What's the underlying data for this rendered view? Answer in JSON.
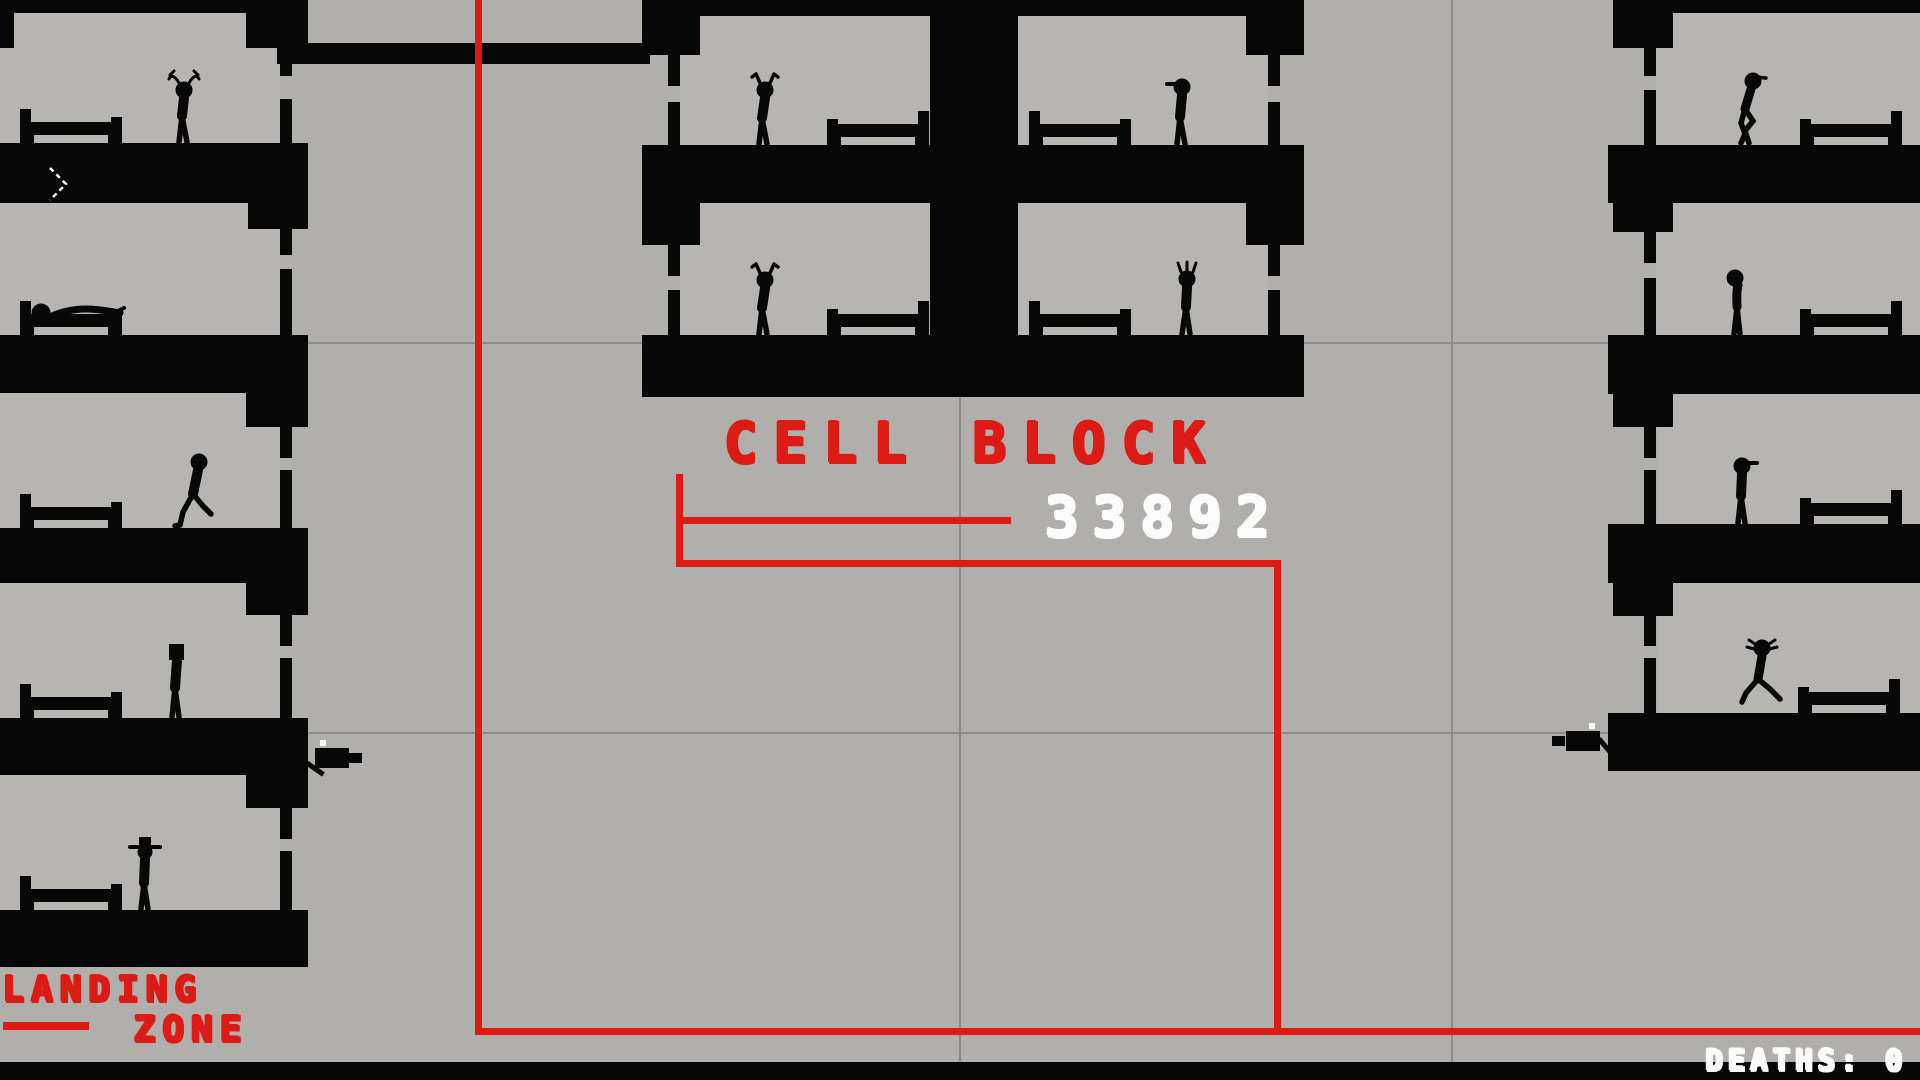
{
  "palette": {
    "background_gray": "#b1afac",
    "cell_interior_gray": "#b7b5b2",
    "structure_black": "#070707",
    "accent_red": "#dd1b15",
    "text_white": "#fbfbfb",
    "gridline_gray": "#8f8d8b"
  },
  "labels": {
    "cell_block_title": "CELL BLOCK",
    "cell_number": "33892",
    "landing_line1": "LANDING",
    "landing_line2": "ZONE"
  },
  "hud": {
    "deaths_counter": "DEATHS: 0"
  },
  "gridlines": {
    "vertical_x": [
      959,
      1451
    ],
    "horizontal_y": [
      342,
      732
    ]
  },
  "red_path": [
    [
      "route-vertical-main",
      475,
      0,
      7,
      1035
    ],
    [
      "route-horizontal-bottom",
      475,
      1028,
      1445,
      7
    ],
    [
      "callout-vertical-label",
      676,
      474,
      7,
      92
    ],
    [
      "callout-horizontal-number",
      676,
      517,
      335,
      7
    ],
    [
      "callout-horizontal-long",
      676,
      560,
      605,
      7
    ],
    [
      "callout-vertical-right",
      1274,
      560,
      7,
      475
    ],
    [
      "landing-dash",
      3,
      1022,
      86,
      8
    ]
  ],
  "interiors": [
    [
      "cell-left-1",
      0,
      13,
      280,
      130
    ],
    [
      "cell-left-2",
      0,
      203,
      280,
      132
    ],
    [
      "cell-left-3",
      0,
      393,
      280,
      135
    ],
    [
      "cell-left-4",
      0,
      583,
      280,
      135
    ],
    [
      "cell-left-5",
      0,
      775,
      280,
      135
    ],
    [
      "cell-center-top-left",
      680,
      16,
      250,
      129
    ],
    [
      "cell-center-top-right",
      1018,
      16,
      250,
      129
    ],
    [
      "cell-center-bottom-left",
      680,
      203,
      250,
      132
    ],
    [
      "cell-center-bottom-right",
      1018,
      203,
      250,
      132
    ],
    [
      "cell-right-1",
      1656,
      13,
      264,
      132
    ],
    [
      "cell-right-2",
      1656,
      203,
      264,
      132
    ],
    [
      "cell-right-3",
      1657,
      394,
      263,
      130
    ],
    [
      "cell-right-4",
      1657,
      583,
      263,
      130
    ]
  ],
  "structures": [
    [
      "left-ceiling",
      0,
      0,
      250,
      13
    ],
    [
      "left-top-stub",
      0,
      13,
      14,
      35
    ],
    [
      "left-corner-1",
      246,
      0,
      62,
      48
    ],
    [
      "left-doorwall-1a",
      280,
      48,
      12,
      28
    ],
    [
      "left-doorwall-1b",
      280,
      99,
      12,
      44
    ],
    [
      "left-floor-1",
      0,
      143,
      308,
      60
    ],
    [
      "left-corner-2",
      248,
      203,
      60,
      26
    ],
    [
      "left-doorwall-2a",
      280,
      229,
      12,
      26
    ],
    [
      "left-doorwall-2b",
      280,
      269,
      12,
      66
    ],
    [
      "left-floor-2",
      0,
      335,
      308,
      58
    ],
    [
      "left-corner-3",
      246,
      393,
      62,
      34
    ],
    [
      "left-doorwall-3a",
      280,
      427,
      12,
      31
    ],
    [
      "left-doorwall-3b",
      280,
      470,
      12,
      58
    ],
    [
      "left-floor-3",
      0,
      528,
      308,
      55
    ],
    [
      "left-corner-4",
      246,
      583,
      62,
      32
    ],
    [
      "left-doorwall-4a",
      280,
      615,
      12,
      31
    ],
    [
      "left-doorwall-4b",
      280,
      658,
      12,
      60
    ],
    [
      "left-floor-4",
      0,
      718,
      308,
      57
    ],
    [
      "left-corner-5",
      246,
      775,
      62,
      33
    ],
    [
      "left-doorwall-5a",
      280,
      808,
      12,
      31
    ],
    [
      "left-doorwall-5b",
      280,
      851,
      12,
      59
    ],
    [
      "left-floor-5",
      0,
      910,
      308,
      57
    ],
    [
      "corridor-bridge-bar",
      277,
      43,
      373,
      21
    ],
    [
      "center-ceiling",
      642,
      0,
      662,
      16
    ],
    [
      "center-corner-tl",
      642,
      0,
      58,
      55
    ],
    [
      "center-corner-tr",
      1246,
      0,
      58,
      55
    ],
    [
      "center-doorwall-l1a",
      668,
      55,
      12,
      31
    ],
    [
      "center-doorwall-l1b",
      668,
      102,
      12,
      43
    ],
    [
      "center-doorwall-r1a",
      1268,
      55,
      12,
      31
    ],
    [
      "center-doorwall-r1b",
      1268,
      102,
      12,
      43
    ],
    [
      "center-pillar",
      930,
      16,
      88,
      319
    ],
    [
      "center-floor-1",
      642,
      145,
      662,
      58
    ],
    [
      "center-corner-ml",
      642,
      203,
      58,
      42
    ],
    [
      "center-corner-mr",
      1246,
      203,
      58,
      42
    ],
    [
      "center-doorwall-l2a",
      668,
      245,
      12,
      31
    ],
    [
      "center-doorwall-l2b",
      668,
      290,
      12,
      45
    ],
    [
      "center-doorwall-r2a",
      1268,
      245,
      12,
      31
    ],
    [
      "center-doorwall-r2b",
      1268,
      290,
      12,
      45
    ],
    [
      "center-floor-2",
      642,
      335,
      662,
      62
    ],
    [
      "right-ceiling",
      1613,
      0,
      307,
      13
    ],
    [
      "right-corner-1",
      1613,
      13,
      60,
      35
    ],
    [
      "right-doorwall-1a",
      1644,
      48,
      12,
      28
    ],
    [
      "right-doorwall-1b",
      1644,
      90,
      12,
      55
    ],
    [
      "right-floor-1",
      1608,
      145,
      312,
      58
    ],
    [
      "right-corner-2",
      1613,
      203,
      60,
      29
    ],
    [
      "right-doorwall-2a",
      1644,
      232,
      12,
      31
    ],
    [
      "right-doorwall-2b",
      1644,
      278,
      12,
      57
    ],
    [
      "right-floor-2",
      1608,
      335,
      312,
      59
    ],
    [
      "right-corner-3",
      1613,
      394,
      60,
      33
    ],
    [
      "right-doorwall-3a",
      1644,
      427,
      12,
      31
    ],
    [
      "right-doorwall-3b",
      1644,
      470,
      12,
      54
    ],
    [
      "right-floor-3",
      1608,
      524,
      312,
      59
    ],
    [
      "right-corner-4",
      1613,
      583,
      60,
      33
    ],
    [
      "right-doorwall-4a",
      1644,
      616,
      12,
      30
    ],
    [
      "right-doorwall-4b",
      1644,
      658,
      12,
      55
    ],
    [
      "right-floor-4",
      1608,
      713,
      312,
      58
    ],
    [
      "bottom-letterbox-bar",
      0,
      1062,
      1920,
      18
    ]
  ],
  "beds": [
    [
      "bed-left-1",
      20,
      143,
      102,
      "left"
    ],
    [
      "bed-left-2",
      20,
      335,
      102,
      "left"
    ],
    [
      "bed-left-3",
      20,
      528,
      102,
      "left"
    ],
    [
      "bed-left-4",
      20,
      718,
      102,
      "left"
    ],
    [
      "bed-left-5",
      20,
      910,
      102,
      "left"
    ],
    [
      "bed-center-tl",
      827,
      145,
      102,
      "right"
    ],
    [
      "bed-center-tr",
      1029,
      145,
      102,
      "left"
    ],
    [
      "bed-center-bl",
      827,
      335,
      102,
      "right"
    ],
    [
      "bed-center-br",
      1029,
      335,
      102,
      "left"
    ],
    [
      "bed-right-1",
      1800,
      145,
      102,
      "right"
    ],
    [
      "bed-right-2",
      1800,
      335,
      102,
      "right"
    ],
    [
      "bed-right-3",
      1800,
      524,
      102,
      "right"
    ],
    [
      "bed-right-4",
      1798,
      713,
      102,
      "right"
    ]
  ],
  "figures": [
    [
      "prisoner-antlers",
      "antlers",
      162,
      143
    ],
    [
      "prisoner-sleeping",
      "sleep",
      20,
      336
    ],
    [
      "prisoner-walking",
      "walk",
      174,
      528
    ],
    [
      "prisoner-flatcap",
      "flatcap",
      155,
      718
    ],
    [
      "prisoner-cowboy",
      "cowboy",
      123,
      910
    ],
    [
      "prisoner-ears-top",
      "ears",
      743,
      145
    ],
    [
      "prisoner-cap-facing-left",
      "capL",
      1160,
      145
    ],
    [
      "prisoner-ears-bottom",
      "ears",
      743,
      335
    ],
    [
      "prisoner-crown",
      "crown",
      1165,
      335
    ],
    [
      "prisoner-crouching",
      "crouch",
      1728,
      145
    ],
    [
      "prisoner-drooping",
      "droop",
      1717,
      335
    ],
    [
      "prisoner-cap-facing-right",
      "capR",
      1720,
      524
    ],
    [
      "prisoner-running",
      "run",
      1740,
      713
    ]
  ],
  "turrets": [
    {
      "name": "wall-gun-turret-left",
      "x": 315,
      "y": 748,
      "dir": "right"
    },
    {
      "name": "wall-gun-turret-right",
      "x": 1552,
      "y": 731,
      "dir": "left"
    }
  ],
  "spawn_marker": {
    "points": "50,168 66,184 50,200"
  }
}
